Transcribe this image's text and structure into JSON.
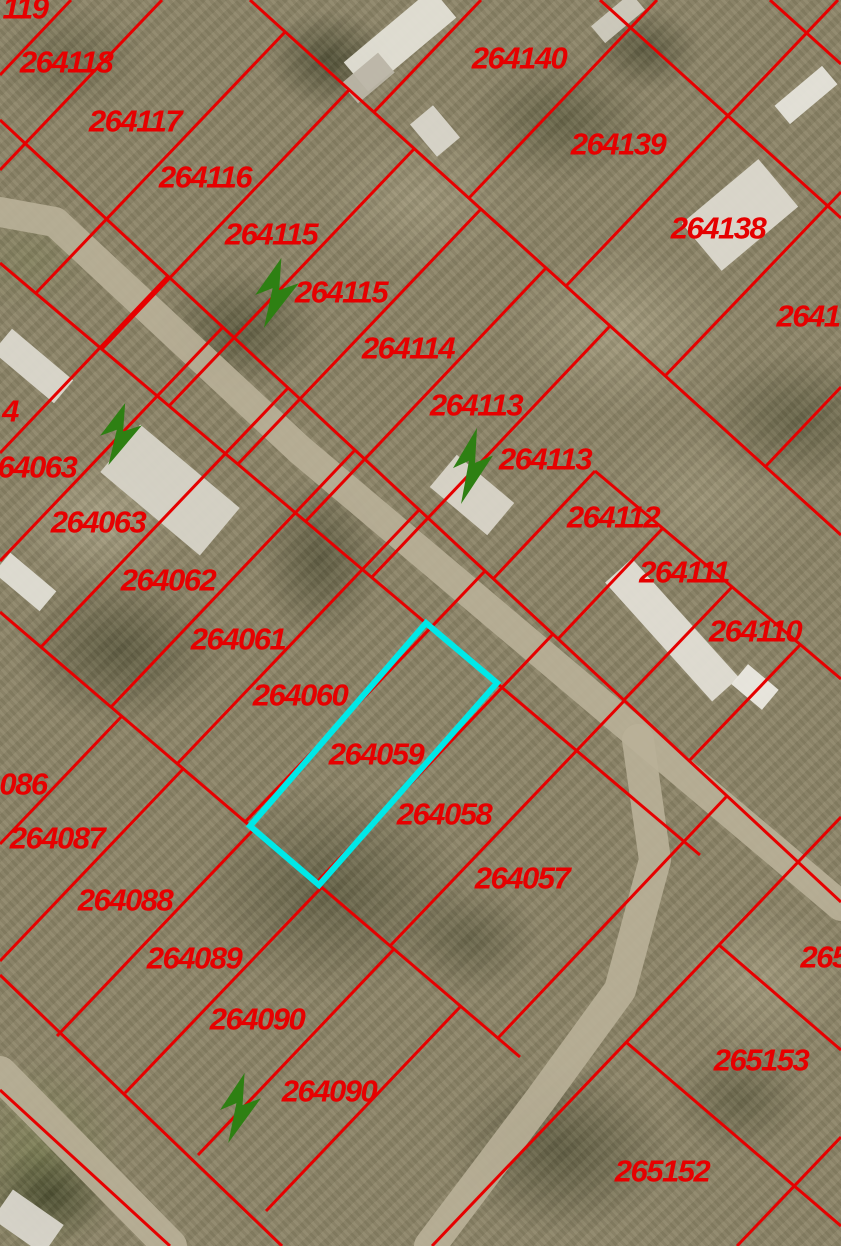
{
  "map": {
    "view": {
      "width": 841,
      "height": 1246
    },
    "palette": {
      "parcel_line": "#e60000",
      "parcel_label": "#e60000",
      "highlight": "#00e8e8",
      "arrow_green": "#2e8013",
      "road": "#b9b098",
      "terrain_base": "#8d8569"
    },
    "highlight_parcel": {
      "label": "264059",
      "points": "426,623 497,683 319,885 250,826",
      "stroke_width": 6
    },
    "parcel_labels": [
      {
        "text": "119",
        "x": 25,
        "y": 8
      },
      {
        "text": "264118",
        "x": 66,
        "y": 62
      },
      {
        "text": "264117",
        "x": 135,
        "y": 121
      },
      {
        "text": "264116",
        "x": 205,
        "y": 177
      },
      {
        "text": "264115",
        "x": 271,
        "y": 234
      },
      {
        "text": "264115",
        "x": 341,
        "y": 292
      },
      {
        "text": "264114",
        "x": 408,
        "y": 348
      },
      {
        "text": "264113",
        "x": 476,
        "y": 405
      },
      {
        "text": "264113",
        "x": 545,
        "y": 459
      },
      {
        "text": "264112",
        "x": 613,
        "y": 517
      },
      {
        "text": "264111",
        "x": 684,
        "y": 572
      },
      {
        "text": "264110",
        "x": 755,
        "y": 631
      },
      {
        "text": "264140",
        "x": 519,
        "y": 58
      },
      {
        "text": "264139",
        "x": 618,
        "y": 144
      },
      {
        "text": "264138",
        "x": 718,
        "y": 228
      },
      {
        "text": "2641",
        "x": 808,
        "y": 316
      },
      {
        "text": "4",
        "x": 10,
        "y": 411
      },
      {
        "text": "264063",
        "x": 29,
        "y": 467
      },
      {
        "text": "264063",
        "x": 98,
        "y": 522
      },
      {
        "text": "264062",
        "x": 168,
        "y": 580
      },
      {
        "text": "264061",
        "x": 238,
        "y": 639
      },
      {
        "text": "264060",
        "x": 300,
        "y": 695
      },
      {
        "text": "264059",
        "x": 376,
        "y": 754
      },
      {
        "text": "264058",
        "x": 444,
        "y": 814
      },
      {
        "text": "264057",
        "x": 522,
        "y": 878
      },
      {
        "text": "086",
        "x": 23,
        "y": 784
      },
      {
        "text": "264087",
        "x": 57,
        "y": 838
      },
      {
        "text": "264088",
        "x": 125,
        "y": 900
      },
      {
        "text": "264089",
        "x": 194,
        "y": 958
      },
      {
        "text": "264090",
        "x": 257,
        "y": 1019
      },
      {
        "text": "264090",
        "x": 329,
        "y": 1091
      },
      {
        "text": "265",
        "x": 824,
        "y": 957
      },
      {
        "text": "265153",
        "x": 761,
        "y": 1060
      },
      {
        "text": "265152",
        "x": 662,
        "y": 1171
      }
    ],
    "parcel_lines": [
      [
        250,
        0,
        841,
        535
      ],
      [
        0,
        120,
        841,
        902
      ],
      [
        595,
        471,
        841,
        679
      ],
      [
        0,
        263,
        700,
        855
      ],
      [
        0,
        612,
        520,
        1057
      ],
      [
        0,
        975,
        282,
        1246
      ],
      [
        0,
        1090,
        170,
        1246
      ],
      [
        600,
        0,
        841,
        218
      ],
      [
        770,
        0,
        841,
        64
      ],
      [
        0,
        75,
        71,
        0
      ],
      [
        0,
        170,
        162,
        0
      ],
      [
        36,
        293,
        285,
        32
      ],
      [
        102,
        349,
        349,
        90
      ],
      [
        169,
        406,
        414,
        149
      ],
      [
        238,
        464,
        481,
        209
      ],
      [
        306,
        521,
        546,
        268
      ],
      [
        372,
        577,
        610,
        326
      ],
      [
        493,
        579,
        595,
        471
      ],
      [
        558,
        639,
        663,
        528
      ],
      [
        624,
        700,
        732,
        587
      ],
      [
        689,
        761,
        800,
        645
      ],
      [
        374,
        112,
        481,
        0
      ],
      [
        469,
        198,
        657,
        0
      ],
      [
        566,
        286,
        838,
        0
      ],
      [
        665,
        376,
        841,
        192
      ],
      [
        765,
        467,
        841,
        387
      ],
      [
        0,
        453,
        168,
        276
      ],
      [
        0,
        561,
        223,
        327
      ],
      [
        41,
        647,
        288,
        388
      ],
      [
        111,
        707,
        355,
        450
      ],
      [
        177,
        764,
        419,
        510
      ],
      [
        245,
        822,
        485,
        571
      ],
      [
        316,
        883,
        553,
        634
      ],
      [
        390,
        946,
        624,
        701
      ],
      [
        498,
        1038,
        727,
        796
      ],
      [
        0,
        844,
        122,
        716
      ],
      [
        0,
        961,
        183,
        769
      ],
      [
        57,
        1036,
        254,
        829
      ],
      [
        125,
        1093,
        322,
        887
      ],
      [
        198,
        1155,
        394,
        949
      ],
      [
        266,
        1211,
        461,
        1006
      ],
      [
        432,
        1246,
        841,
        817
      ],
      [
        626,
        1042,
        841,
        1226
      ],
      [
        719,
        945,
        841,
        1050
      ],
      [
        737,
        1246,
        841,
        1137
      ]
    ],
    "roads": [
      {
        "points": "0,212 55,222 300,450 841,906",
        "width": 30
      },
      {
        "points": "638,740 655,860 620,990 540,1100 430,1246",
        "width": 32
      },
      {
        "points": "0,1073 170,1246",
        "width": 34
      }
    ],
    "buildings": [
      {
        "cx": 400,
        "cy": 40,
        "w": 115,
        "h": 38,
        "rot": -40,
        "fill": "#e3e0d6"
      },
      {
        "cx": 368,
        "cy": 78,
        "w": 48,
        "h": 26,
        "rot": -40,
        "fill": "#bab5a6"
      },
      {
        "cx": 435,
        "cy": 131,
        "w": 30,
        "h": 42,
        "rot": -40,
        "fill": "#d9d6cb"
      },
      {
        "cx": 740,
        "cy": 215,
        "w": 100,
        "h": 62,
        "rot": -40,
        "fill": "#dcd9cf"
      },
      {
        "cx": 806,
        "cy": 95,
        "w": 62,
        "h": 24,
        "rot": -40,
        "fill": "#e6e4db"
      },
      {
        "cx": 33,
        "cy": 366,
        "w": 80,
        "h": 30,
        "rot": 40,
        "fill": "#dbd8ce"
      },
      {
        "cx": 25,
        "cy": 582,
        "w": 60,
        "h": 26,
        "rot": 40,
        "fill": "#e0ded5"
      },
      {
        "cx": 170,
        "cy": 490,
        "w": 130,
        "h": 62,
        "rot": 40,
        "fill": "#d7d4c8"
      },
      {
        "cx": 472,
        "cy": 495,
        "w": 75,
        "h": 42,
        "rot": 40,
        "fill": "#d9d5c9"
      },
      {
        "cx": 672,
        "cy": 630,
        "w": 160,
        "h": 36,
        "rot": 48,
        "fill": "#e1ded5"
      },
      {
        "cx": 755,
        "cy": 687,
        "w": 40,
        "h": 26,
        "rot": 40,
        "fill": "#ebe9e1"
      },
      {
        "cx": 28,
        "cy": 1222,
        "w": 62,
        "h": 36,
        "rot": 35,
        "fill": "#d9d6cc"
      },
      {
        "cx": 618,
        "cy": 18,
        "w": 52,
        "h": 22,
        "rot": -40,
        "fill": "#cfcbbf"
      }
    ],
    "arrow_markers": [
      {
        "x": 253,
        "y": 258,
        "w": 48,
        "h": 70
      },
      {
        "x": 451,
        "y": 428,
        "w": 44,
        "h": 76
      },
      {
        "x": 98,
        "y": 403,
        "w": 46,
        "h": 62
      },
      {
        "x": 218,
        "y": 1073,
        "w": 45,
        "h": 70
      }
    ],
    "arrow_path": "M26,0 L2,38 L18,31 L10,72 L42,26 L24,33 Z"
  }
}
